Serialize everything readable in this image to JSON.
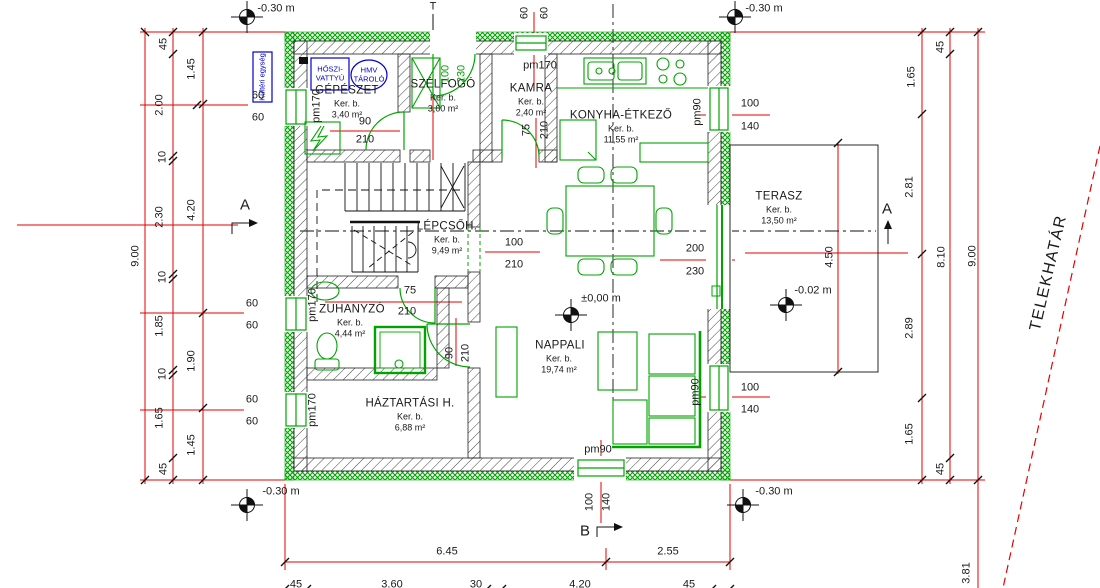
{
  "drawing": {
    "type": "floor-plan",
    "language": "hu"
  },
  "colors": {
    "wall_green": "#00A300",
    "dim_red": "#E60000",
    "equipment_blue": "#0000CC",
    "line_black": "#1A1A1A"
  },
  "rooms": [
    {
      "name": "GÉPÉSZET",
      "type": "Ker. b.",
      "area": "3,40 m²"
    },
    {
      "name": "SZÉLFOGÓ",
      "type": "Ker. b.",
      "area": "3,60 m²"
    },
    {
      "name": "KAMRA",
      "type": "Ker. b.",
      "area": "2,40 m²"
    },
    {
      "name": "KONYHA-ÉTKEZŐ",
      "type": "Ker. b.",
      "area": "11,55 m²"
    },
    {
      "name": "LÉPCSŐH.",
      "type": "Ker. b.",
      "area": "9,49 m²"
    },
    {
      "name": "TERASZ",
      "type": "Ker. b.",
      "area": "13,50 m²"
    },
    {
      "name": "ZUHANYZÓ",
      "type": "Ker. b.",
      "area": "4,44 m²"
    },
    {
      "name": "NAPPALI",
      "type": "Ker. b.",
      "area": "19,74 m²"
    },
    {
      "name": "HÁZTARTÁSI H.",
      "type": "Ker. b.",
      "area": "6,88 m²"
    }
  ],
  "equipment": {
    "outdoor_unit": "Kültéri egység",
    "heat_pump_l1": "HŐSZI-",
    "heat_pump_l2": "VATTYÚ",
    "hmv_l1": "HMV",
    "hmv_l2": "TÁROLÓ"
  },
  "boundary": {
    "label": "TELEKHATÁR"
  },
  "annotations": [
    {
      "name": "level-top-left",
      "t": "-0.30 m",
      "x": 276,
      "y": 9
    },
    {
      "name": "level-top-right",
      "t": "-0.30 m",
      "x": 764,
      "y": 9
    },
    {
      "name": "level-bottom-left",
      "t": "-0.30 m",
      "x": 281,
      "y": 492
    },
    {
      "name": "level-bottom-right",
      "t": "-0.30 m",
      "x": 774,
      "y": 492
    },
    {
      "name": "level-terrace",
      "t": "-0.02 m",
      "x": 813,
      "y": 291
    },
    {
      "name": "level-main",
      "t": "±0,00 m",
      "x": 601,
      "y": 299
    },
    {
      "name": "pm-gepeszet",
      "t": "pm170",
      "x": 317,
      "y": 106,
      "cls": "r90"
    },
    {
      "name": "pm-kamra",
      "t": "pm170",
      "x": 540,
      "y": 66
    },
    {
      "name": "pm-zuhanyzo",
      "t": "pm170",
      "x": 313,
      "y": 305,
      "cls": "r90"
    },
    {
      "name": "pm-haztartasi",
      "t": "pm170",
      "x": 313,
      "y": 410,
      "cls": "r90"
    },
    {
      "name": "pm-konyha",
      "t": "pm90",
      "x": 698,
      "y": 112,
      "cls": "r90"
    },
    {
      "name": "pm-nappali",
      "t": "pm90",
      "x": 696,
      "y": 392,
      "cls": "r90"
    },
    {
      "name": "pm-nappali-south",
      "t": "pm90",
      "x": 598,
      "y": 450
    },
    {
      "name": "dim-gepeszet-door-w",
      "t": "90",
      "x": 365,
      "y": 122
    },
    {
      "name": "dim-gepeszet-door-h",
      "t": "210",
      "x": 365,
      "y": 140
    },
    {
      "name": "dim-entrance-w",
      "t": "100",
      "x": 446,
      "y": 74,
      "cls": "r90 green"
    },
    {
      "name": "dim-entrance-h",
      "t": "230",
      "x": 462,
      "y": 74,
      "cls": "r90 green"
    },
    {
      "name": "dim-top-window-a",
      "t": "60",
      "x": 525,
      "y": 13,
      "cls": "r90"
    },
    {
      "name": "dim-top-window-b",
      "t": "60",
      "x": 545,
      "y": 13,
      "cls": "r90"
    },
    {
      "name": "dim-kamra-door-w",
      "t": "75",
      "x": 527,
      "y": 130,
      "cls": "r90"
    },
    {
      "name": "dim-kamra-door-h",
      "t": "210",
      "x": 545,
      "y": 130,
      "cls": "r90"
    },
    {
      "name": "dim-konyha-window-w",
      "t": "100",
      "x": 750,
      "y": 104
    },
    {
      "name": "dim-konyha-window-h",
      "t": "140",
      "x": 750,
      "y": 127
    },
    {
      "name": "dim-terrace-door-w",
      "t": "200",
      "x": 695,
      "y": 249
    },
    {
      "name": "dim-terrace-door-h",
      "t": "230",
      "x": 695,
      "y": 272
    },
    {
      "name": "dim-hall-door-w",
      "t": "100",
      "x": 514,
      "y": 243
    },
    {
      "name": "dim-hall-door-h",
      "t": "210",
      "x": 514,
      "y": 265
    },
    {
      "name": "dim-zuhanyzo-door-w",
      "t": "75",
      "x": 410,
      "y": 291
    },
    {
      "name": "dim-zuhanyzo-door-h",
      "t": "210",
      "x": 407,
      "y": 312
    },
    {
      "name": "dim-haztartasi-door-w",
      "t": "90",
      "x": 450,
      "y": 353,
      "cls": "r90"
    },
    {
      "name": "dim-haztartasi-door-h",
      "t": "210",
      "x": 466,
      "y": 353,
      "cls": "r90"
    },
    {
      "name": "dim-nappali-window-w",
      "t": "100",
      "x": 750,
      "y": 388
    },
    {
      "name": "dim-nappali-window-h",
      "t": "140",
      "x": 750,
      "y": 410
    },
    {
      "name": "dim-south-window-w",
      "t": "100",
      "x": 590,
      "y": 502,
      "cls": "r90"
    },
    {
      "name": "dim-south-window-h",
      "t": "140",
      "x": 607,
      "y": 502,
      "cls": "r90"
    },
    {
      "name": "dim-left-win1-a",
      "t": "60",
      "x": 258,
      "y": 96
    },
    {
      "name": "dim-left-win1-b",
      "t": "60",
      "x": 258,
      "y": 118
    },
    {
      "name": "dim-left-win2-a",
      "t": "60",
      "x": 252,
      "y": 304
    },
    {
      "name": "dim-left-win2-b",
      "t": "60",
      "x": 252,
      "y": 326
    },
    {
      "name": "dim-left-win3-a",
      "t": "60",
      "x": 252,
      "y": 400
    },
    {
      "name": "dim-left-win3-b",
      "t": "60",
      "x": 252,
      "y": 422
    },
    {
      "name": "dim-left-45a",
      "t": "45",
      "x": 164,
      "y": 44,
      "cls": "r90"
    },
    {
      "name": "dim-left-200",
      "t": "2.00",
      "x": 160,
      "y": 105,
      "cls": "r90"
    },
    {
      "name": "dim-left-10a",
      "t": "10",
      "x": 163,
      "y": 157,
      "cls": "r90"
    },
    {
      "name": "dim-left-230",
      "t": "2.30",
      "x": 160,
      "y": 217,
      "cls": "r90"
    },
    {
      "name": "dim-left-10b",
      "t": "10",
      "x": 163,
      "y": 277,
      "cls": "r90"
    },
    {
      "name": "dim-left-185",
      "t": "1.85",
      "x": 160,
      "y": 326,
      "cls": "r90"
    },
    {
      "name": "dim-left-10c",
      "t": "10",
      "x": 163,
      "y": 374,
      "cls": "r90"
    },
    {
      "name": "dim-left-165",
      "t": "1.65",
      "x": 160,
      "y": 418,
      "cls": "r90"
    },
    {
      "name": "dim-left-45b",
      "t": "45",
      "x": 164,
      "y": 469,
      "cls": "r90"
    },
    {
      "name": "dim-left-145a",
      "t": "1.45",
      "x": 192,
      "y": 69,
      "cls": "r90"
    },
    {
      "name": "dim-left-420",
      "t": "4.20",
      "x": 192,
      "y": 210,
      "cls": "r90"
    },
    {
      "name": "dim-left-190",
      "t": "1.90",
      "x": 192,
      "y": 361,
      "cls": "r90"
    },
    {
      "name": "dim-left-145b",
      "t": "1.45",
      "x": 192,
      "y": 445,
      "cls": "r90"
    },
    {
      "name": "dim-left-total",
      "t": "9.00",
      "x": 136,
      "y": 256,
      "cls": "r90"
    },
    {
      "name": "dim-right-45a",
      "t": "45",
      "x": 941,
      "y": 47,
      "cls": "r90"
    },
    {
      "name": "dim-right-165a",
      "t": "1.65",
      "x": 912,
      "y": 77,
      "cls": "r90"
    },
    {
      "name": "dim-right-281",
      "t": "2.81",
      "x": 910,
      "y": 187,
      "cls": "r90"
    },
    {
      "name": "dim-right-289",
      "t": "2.89",
      "x": 910,
      "y": 328,
      "cls": "r90"
    },
    {
      "name": "dim-right-165b",
      "t": "1.65",
      "x": 910,
      "y": 434,
      "cls": "r90"
    },
    {
      "name": "dim-right-45b",
      "t": "45",
      "x": 941,
      "y": 469,
      "cls": "r90"
    },
    {
      "name": "dim-right-810",
      "t": "8.10",
      "x": 942,
      "y": 257,
      "cls": "r90"
    },
    {
      "name": "dim-right-total",
      "t": "9.00",
      "x": 973,
      "y": 256,
      "cls": "r90"
    },
    {
      "name": "dim-terrace-depth",
      "t": "4.50",
      "x": 830,
      "y": 257,
      "cls": "r90"
    },
    {
      "name": "dim-right-381",
      "t": "3.81",
      "x": 967,
      "y": 573,
      "cls": "r90"
    },
    {
      "name": "dim-bottom-645",
      "t": "6.45",
      "x": 447,
      "y": 552
    },
    {
      "name": "dim-bottom-255",
      "t": "2.55",
      "x": 668,
      "y": 552
    },
    {
      "name": "dim-bottom-45a",
      "t": "45",
      "x": 296,
      "y": 585
    },
    {
      "name": "dim-bottom-360",
      "t": "3.60",
      "x": 392,
      "y": 585
    },
    {
      "name": "dim-bottom-30",
      "t": "30",
      "x": 476,
      "y": 585
    },
    {
      "name": "dim-bottom-420",
      "t": "4.20",
      "x": 580,
      "y": 585
    },
    {
      "name": "dim-bottom-45b",
      "t": "45",
      "x": 689,
      "y": 585
    },
    {
      "name": "section-a-left",
      "t": "A",
      "x": 245,
      "y": 205,
      "cls": "big"
    },
    {
      "name": "section-a-right",
      "t": "A",
      "x": 887,
      "y": 209,
      "cls": "big"
    },
    {
      "name": "section-b",
      "t": "B",
      "x": 585,
      "y": 531,
      "cls": "big"
    },
    {
      "name": "marker-t",
      "t": "T",
      "x": 433,
      "y": 7
    }
  ]
}
